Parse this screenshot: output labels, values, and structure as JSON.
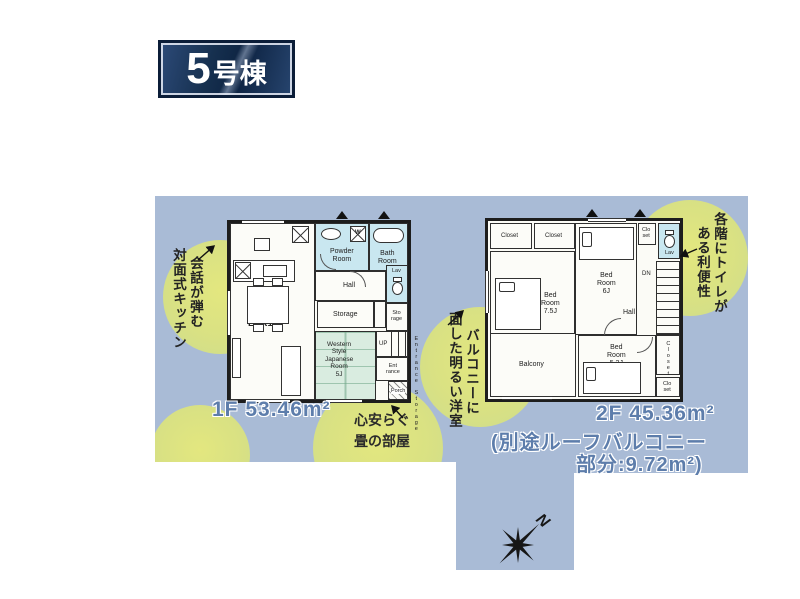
{
  "badge": {
    "number": "5",
    "suffix": "号棟"
  },
  "floor1": {
    "area": "1F 53.46m²",
    "rooms": {
      "ldk": "LDK16J",
      "powder": "Powder\nRoom",
      "bath": "Bath\nRoom",
      "hall": "Hall",
      "storage": "Storage",
      "lav": "Lav",
      "storage_small": "Sto\nrage",
      "tatami": "Western\nStyle\nJapanese\nRoom\n5J",
      "up": "UP",
      "entrance": "Ent\nrance",
      "porch": "Porch",
      "entrance_storage": "Entrance Storage",
      "washer": "W"
    }
  },
  "floor2": {
    "area": "2F 45.36m²",
    "note1": "(別途ルーフバルコニー",
    "note2": "部分:9.72m²)",
    "rooms": {
      "closet1": "Closet",
      "closet2": "Closet",
      "bed75": "Bed\nRoom\n7.5J",
      "bed6": "Bed\nRoom\n6J",
      "closet_small_top": "Clo\nset",
      "lav": "Lav",
      "dn": "DN",
      "hall": "Hall",
      "balcony": "Balcony",
      "bed52": "Bed\nRoom\n5.2J",
      "closet_right": "Closet",
      "closet_small_bottom": "Clo\nset"
    }
  },
  "callouts": {
    "kitchen": {
      "line1": "会話が弾む",
      "line2": "対面式キッチン"
    },
    "balcony": {
      "line1": "バルコニーに",
      "line2": "面した明るい洋室"
    },
    "toilet": {
      "line1": "各階にトイレが",
      "line2": "ある利便性"
    },
    "tatami": {
      "line1": "心安らぐ",
      "line2": "畳の部屋"
    }
  },
  "compass": {
    "label": "N"
  },
  "colors": {
    "panel_blue": "#a9bbd6",
    "highlight_green": "#dce384",
    "wet_area_blue": "#c9e7f0",
    "tatami_green": "#d9ece0",
    "badge_navy": "#12294d",
    "area_text_blue": "#5d7dab"
  }
}
